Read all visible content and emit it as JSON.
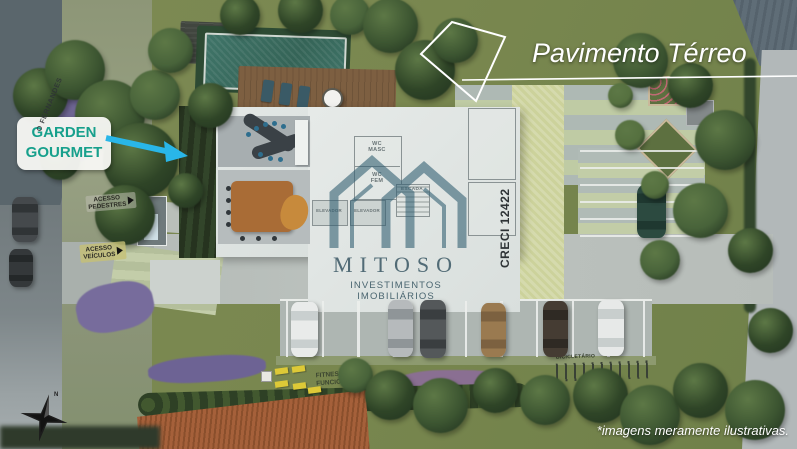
{
  "banner": {
    "title": "Pavimento Térreo"
  },
  "callout_garden_gourmet": {
    "line1": "GARDEN",
    "line2": "GOURMET"
  },
  "street_sign": {
    "name": "O FERNANDES"
  },
  "access_labels": {
    "pedestrian_line1": "ACESSO",
    "pedestrian_line2": "PEDESTRES",
    "vehicle_line1": "ACESSO",
    "vehicle_line2": "VEÍCULOS"
  },
  "plan_room_labels": {
    "wc_masc_line1": "WC",
    "wc_masc_line2": "MASC",
    "wc_fem_line1": "WC",
    "wc_fem_line2": "FEM",
    "escada": "ESCADA",
    "elevador_left": "ELEVADOR",
    "elevador_right": "ELEVADOR"
  },
  "amenity_labels": {
    "fitness_line1": "FITNESS",
    "fitness_line2": "FUNCIONAL",
    "bike_rack": "BICICLETÁRIO"
  },
  "watermark": {
    "brand": "MITOSO",
    "tagline": "INVESTIMENTOS IMOBILIÁRIOS",
    "creci": "CRECI 12422"
  },
  "compass": {
    "north_label": "N"
  },
  "disclaimer": {
    "text": "*imagens meramente ilustrativas."
  },
  "colors": {
    "callout_text": "#17a08c",
    "callout_arrow": "#29b6e8",
    "watermark_teal": "#2f5d70",
    "banner_text": "#ffffff",
    "fitness_mat": "#ddc937",
    "pool_water": "#3f7468"
  }
}
